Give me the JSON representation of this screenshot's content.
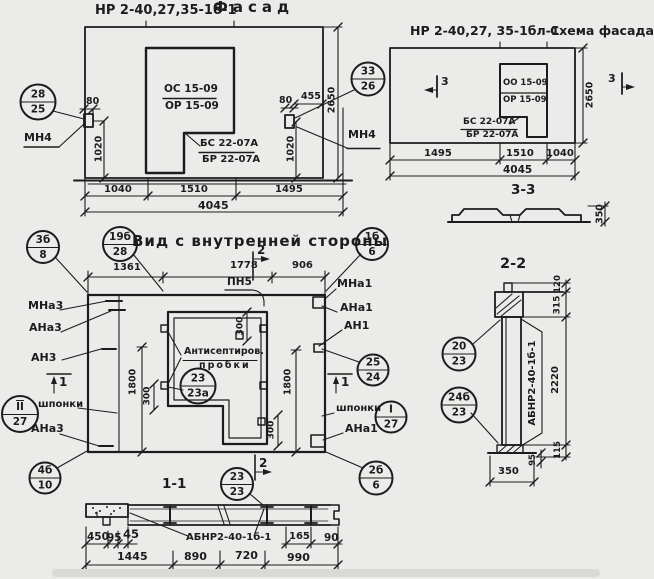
{
  "colors": {
    "ink": "#1c1c1c",
    "paper": "#ebebe9"
  },
  "facade": {
    "title_code": "НР 2-40,27,35-1б-1",
    "title_name": "Фасад",
    "callouts": [
      {
        "top": "28",
        "bottom": "25"
      },
      {
        "top": "33",
        "bottom": "26"
      }
    ],
    "labels": {
      "mn4_left": "МН4",
      "mn4_right": "МН4",
      "window_top": "ОС 15-09",
      "window_bottom": "ОР 15-09",
      "sill_top": "БС 22-07А",
      "sill_bottom": "БР 22-07А"
    },
    "dims": {
      "d80_left": "80",
      "d1020_left": "1020",
      "d80_right": "80",
      "d455": "455",
      "d1020_right": "1020",
      "d2650": "2650",
      "bottom": [
        "1040",
        "1510",
        "1495"
      ],
      "total": "4045"
    }
  },
  "schema": {
    "title_code": "НР 2-40,27, 35-1бл-1",
    "title_name": "Схема фасада",
    "cut_marker": "3",
    "labels": {
      "window_top": "ОО 15-09",
      "window_bottom": "ОР 15-09",
      "sill_top": "БС 22-07А",
      "sill_bottom": "БР 22-07А"
    },
    "dims": {
      "d2650": "2650",
      "bottom": [
        "1495",
        "1510",
        "1040"
      ],
      "total": "4045"
    },
    "section": {
      "title": "3-3",
      "d350": "350"
    }
  },
  "inner": {
    "title": "Вид с внутренней стороны",
    "callouts": {
      "c19b_28": {
        "top": "19б",
        "bottom": "28"
      },
      "c1b_6": {
        "top": "1б",
        "bottom": "6"
      },
      "c3b_8": {
        "top": "3б",
        "bottom": "8"
      },
      "cII_27": {
        "top": "II",
        "bottom": "27"
      },
      "c4b_10": {
        "top": "4б",
        "bottom": "10"
      },
      "c25_24": {
        "top": "25",
        "bottom": "24"
      },
      "cI_27": {
        "top": "I",
        "bottom": "27"
      },
      "c2b_6": {
        "top": "2б",
        "bottom": "6"
      },
      "c23_23a": {
        "top": "23",
        "bottom": "23а"
      },
      "c23_23": {
        "top": "23",
        "bottom": "23"
      }
    },
    "labels": {
      "mna3": "МНа3",
      "ana3": "АНа3",
      "an3": "АН3",
      "shponki_left": "шпонки",
      "ana3_bottom": "АНа3",
      "pn5": "ПН5",
      "mna1": "МНа1",
      "ana1": "АНа1",
      "an1": "АН1",
      "shponki_right": "шпонки",
      "ana1_bottom": "АНа1",
      "plugs_line1": "Антисептиров.",
      "plugs_line2": "пробки"
    },
    "cut_markers": {
      "m1": "1",
      "m2": "2"
    },
    "dims": {
      "top": [
        "1361",
        "1778",
        "906"
      ],
      "d1800_left": "1800",
      "d1800_right": "1800",
      "d300_top": "300",
      "d300_left": "300",
      "d300_bottom": "300"
    }
  },
  "section_1_1": {
    "title": "1-1",
    "panel_label": "АБНР2-40-1б-1",
    "dims": {
      "row1": [
        "450",
        "95",
        "45"
      ],
      "d165": "165",
      "d90": "90",
      "row2": [
        "1445",
        "890",
        "720",
        "990"
      ]
    }
  },
  "section_2_2": {
    "title": "2-2",
    "panel_label": "АБНР2-40-1б-1",
    "callouts": {
      "c20_23": {
        "top": "20",
        "bottom": "23"
      },
      "c24b_23": {
        "top": "24б",
        "bottom": "23"
      }
    },
    "dims": {
      "d120": "120",
      "d315": "315",
      "d2220": "2220",
      "d115": "115",
      "d95": "95",
      "d350": "350"
    }
  }
}
